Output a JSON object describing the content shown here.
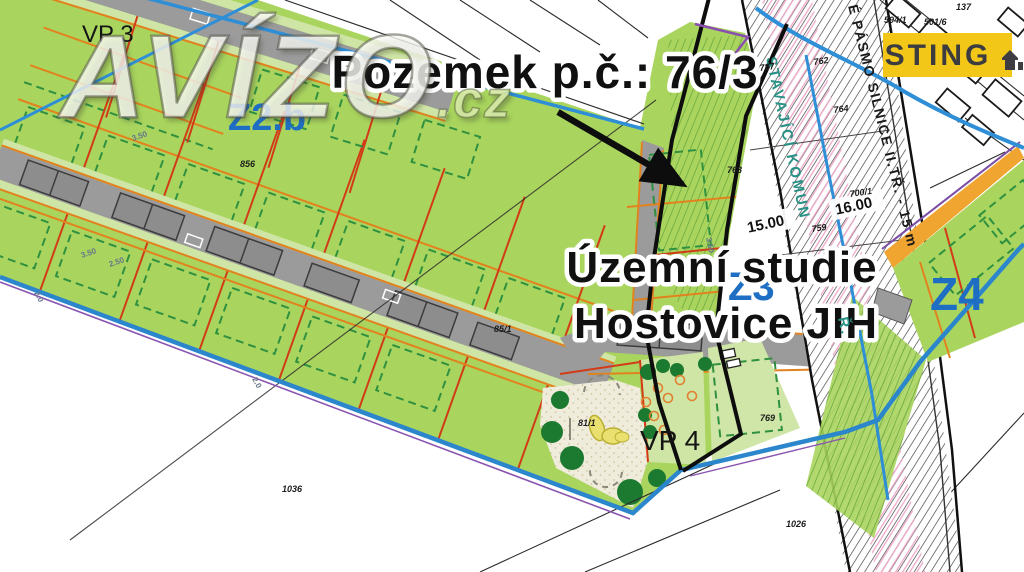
{
  "title": "Územní studie Hostovice JIH – situační výkres",
  "watermark": {
    "name": "AVÍZO",
    "tld": ".cz"
  },
  "badge": {
    "label": "STING"
  },
  "callout": {
    "parcel": "Pozemek p.č.: 76/3"
  },
  "study": {
    "line1": "Územní studie",
    "line2": "Hostovice JIH"
  },
  "zones": {
    "z2b": "Z2.b",
    "z3": "Z3",
    "z4": "Z4",
    "vp3": "VP 3",
    "vp4": "VP 4"
  },
  "road_labels": {
    "protection": "É PÁSMO SILNICE II.TŘ. - 15 m",
    "existing": "STAVAJÍCÍ KOMUN",
    "existing_suffix": "Ř."
  },
  "dimensions": {
    "d1": "15.00",
    "d2": "16.00",
    "w1": "3.50",
    "w2": "3.50",
    "w3": "2.50",
    "w4": "2.0",
    "w5": "2.0",
    "w6": "3.50"
  },
  "parcel_numbers": {
    "p137": "137",
    "p5016": "501/6",
    "p5941": "594/1",
    "p787": "787",
    "p762": "762",
    "p764": "764",
    "p759": "759",
    "p7001": "700/1",
    "p763": "763",
    "p769": "769",
    "p811": "81/1",
    "p1026": "1026",
    "p1036": "1036",
    "p856": "856",
    "p851": "85/1"
  },
  "colors": {
    "parcel_green": "#a9d55e",
    "light_green": "#cfe5a5",
    "road_gray": "#9b9b9b",
    "garage_gray": "#8d8d8d",
    "parcel_red": "#d23b18",
    "accent_orange": "#e2821e",
    "boundary_blue": "#2b86cc",
    "outline_purple": "#8a55b0",
    "zone_label_blue": "#1e6fc4",
    "badge_yellow": "#f2c718",
    "hatch_pink": "#efa9c9",
    "teal": "#2a9186",
    "tree_green": "#1c7a30",
    "park_beige": "#f0ecdc"
  }
}
